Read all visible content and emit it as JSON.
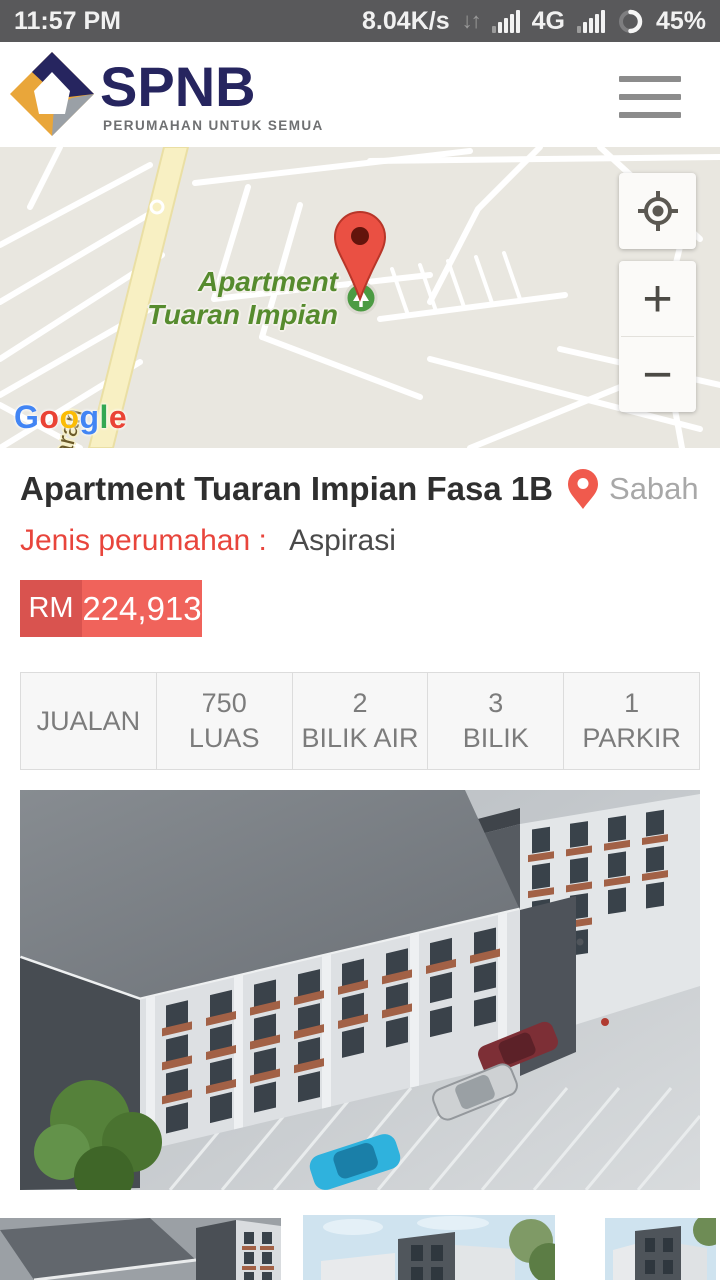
{
  "status_bar": {
    "time": "11:57 PM",
    "net_speed": "8.04K/s",
    "net_type": "4G",
    "battery_pct": "45%"
  },
  "icons": {
    "net_activity_glyph": "↓↑"
  },
  "header": {
    "brand": "SPNB",
    "tagline": "PERUMAHAN UNTUK SEMUA"
  },
  "map": {
    "poi_line1": "Apartment",
    "poi_line2": "Tuaran Impian",
    "road_label": "Jalan Tuaran",
    "attribution_letters": [
      "G",
      "o",
      "o",
      "g",
      "l",
      "e"
    ],
    "zoom_in": "+",
    "zoom_out": "−"
  },
  "listing": {
    "title": "Apartment Tuaran Impian Fasa 1B",
    "location": "Sabah",
    "type_label": "Jenis perumahan :",
    "type_value": "Aspirasi",
    "currency": "RM",
    "price": "224,913",
    "specs": [
      {
        "value": "",
        "label": "JUALAN"
      },
      {
        "value": "750",
        "label": "LUAS"
      },
      {
        "value": "2",
        "label": "BILIK AIR"
      },
      {
        "value": "3",
        "label": "BILIK"
      },
      {
        "value": "1",
        "label": "PARKIR"
      }
    ]
  },
  "colors": {
    "brand_navy": "#26255f",
    "brand_gold": "#e9a63a",
    "brand_gray": "#9aa0a6",
    "accent_red": "#e8453c",
    "price_dark_red": "#d9534f",
    "price_light_red": "#f0635b",
    "map_poi_green": "#568b2e",
    "marker_red": "#ea5043",
    "status_bar_bg": "#59595b"
  }
}
